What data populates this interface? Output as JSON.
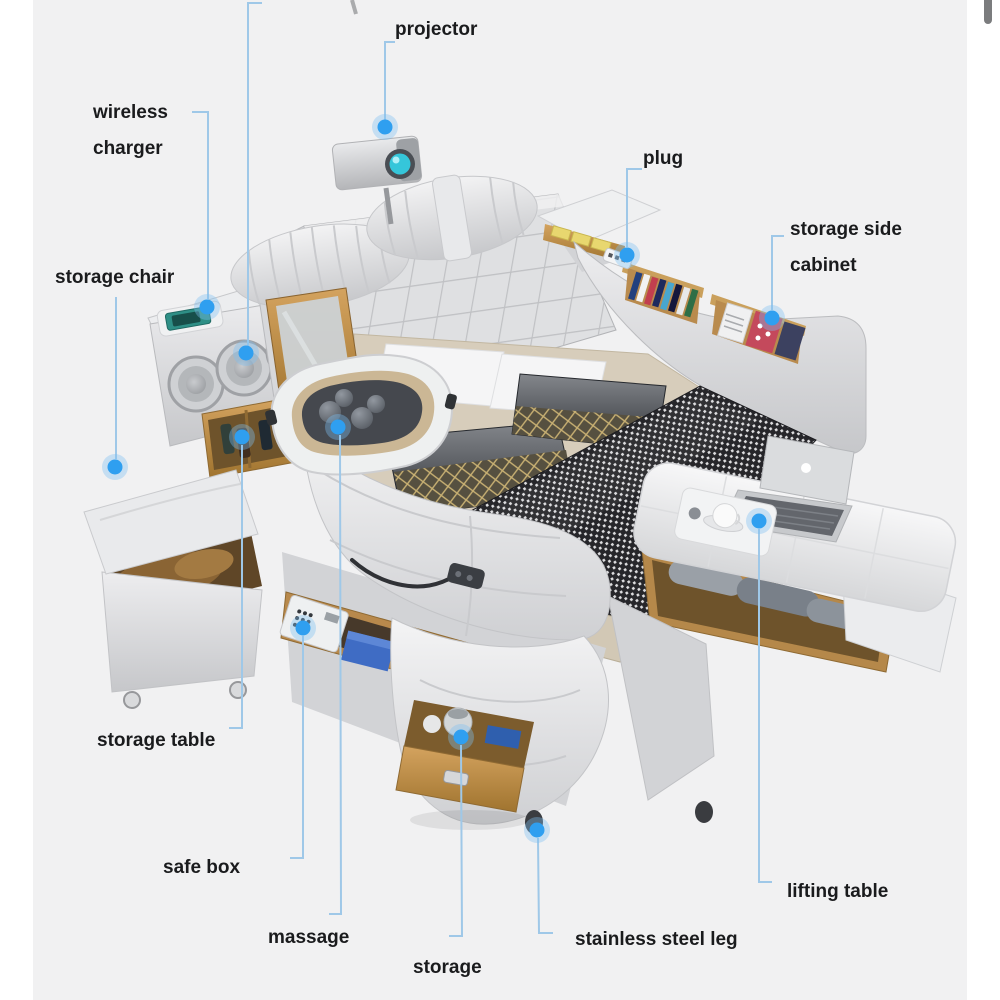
{
  "annotations": {
    "projector": {
      "label": "projector"
    },
    "wireless_charger": {
      "line1": "wireless",
      "line2": "charger"
    },
    "plug": {
      "label": "plug"
    },
    "storage_side_cabinet": {
      "line1": "storage side",
      "line2": "cabinet"
    },
    "storage_chair": {
      "label": "storage chair"
    },
    "storage_table": {
      "label": "storage table"
    },
    "safe_box": {
      "label": "safe box"
    },
    "massage": {
      "label": "massage"
    },
    "storage": {
      "label": "storage"
    },
    "stainless_steel_leg": {
      "label": "stainless steel leg"
    },
    "lifting_table": {
      "label": "lifting table"
    }
  },
  "colors": {
    "background": "#f1f1f2",
    "label_text": "#1a1b1d",
    "leader_line": "#9fc8e8",
    "dot_core": "#2f9ff0",
    "dot_halo": "#7fc0f2",
    "leather": "#d9dadc",
    "wood": "#c2924f",
    "blanket": "#26262a",
    "sheet": "#d2c8b5",
    "lens": "#35c6da",
    "phone": "#2e8f86"
  }
}
